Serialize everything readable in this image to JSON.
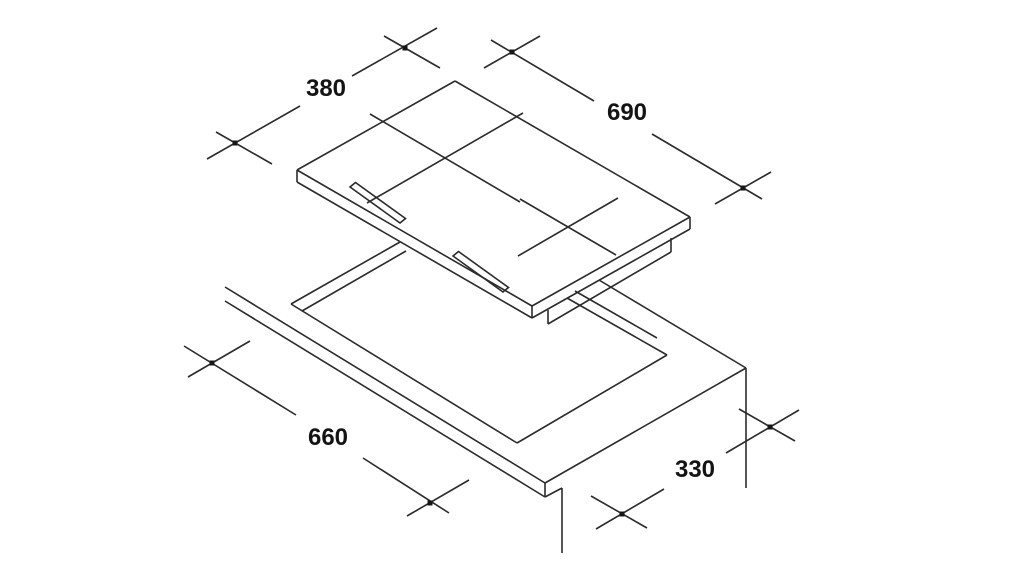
{
  "drawing": {
    "type": "installation-diagram",
    "subject": "cooktop-hob-and-worktop-cutout",
    "line_color": "#2b2b2b",
    "background_color": "#ffffff",
    "dimensions": {
      "hob_width": "380",
      "hob_length": "690",
      "cutout_length": "660",
      "cutout_width": "330"
    }
  }
}
